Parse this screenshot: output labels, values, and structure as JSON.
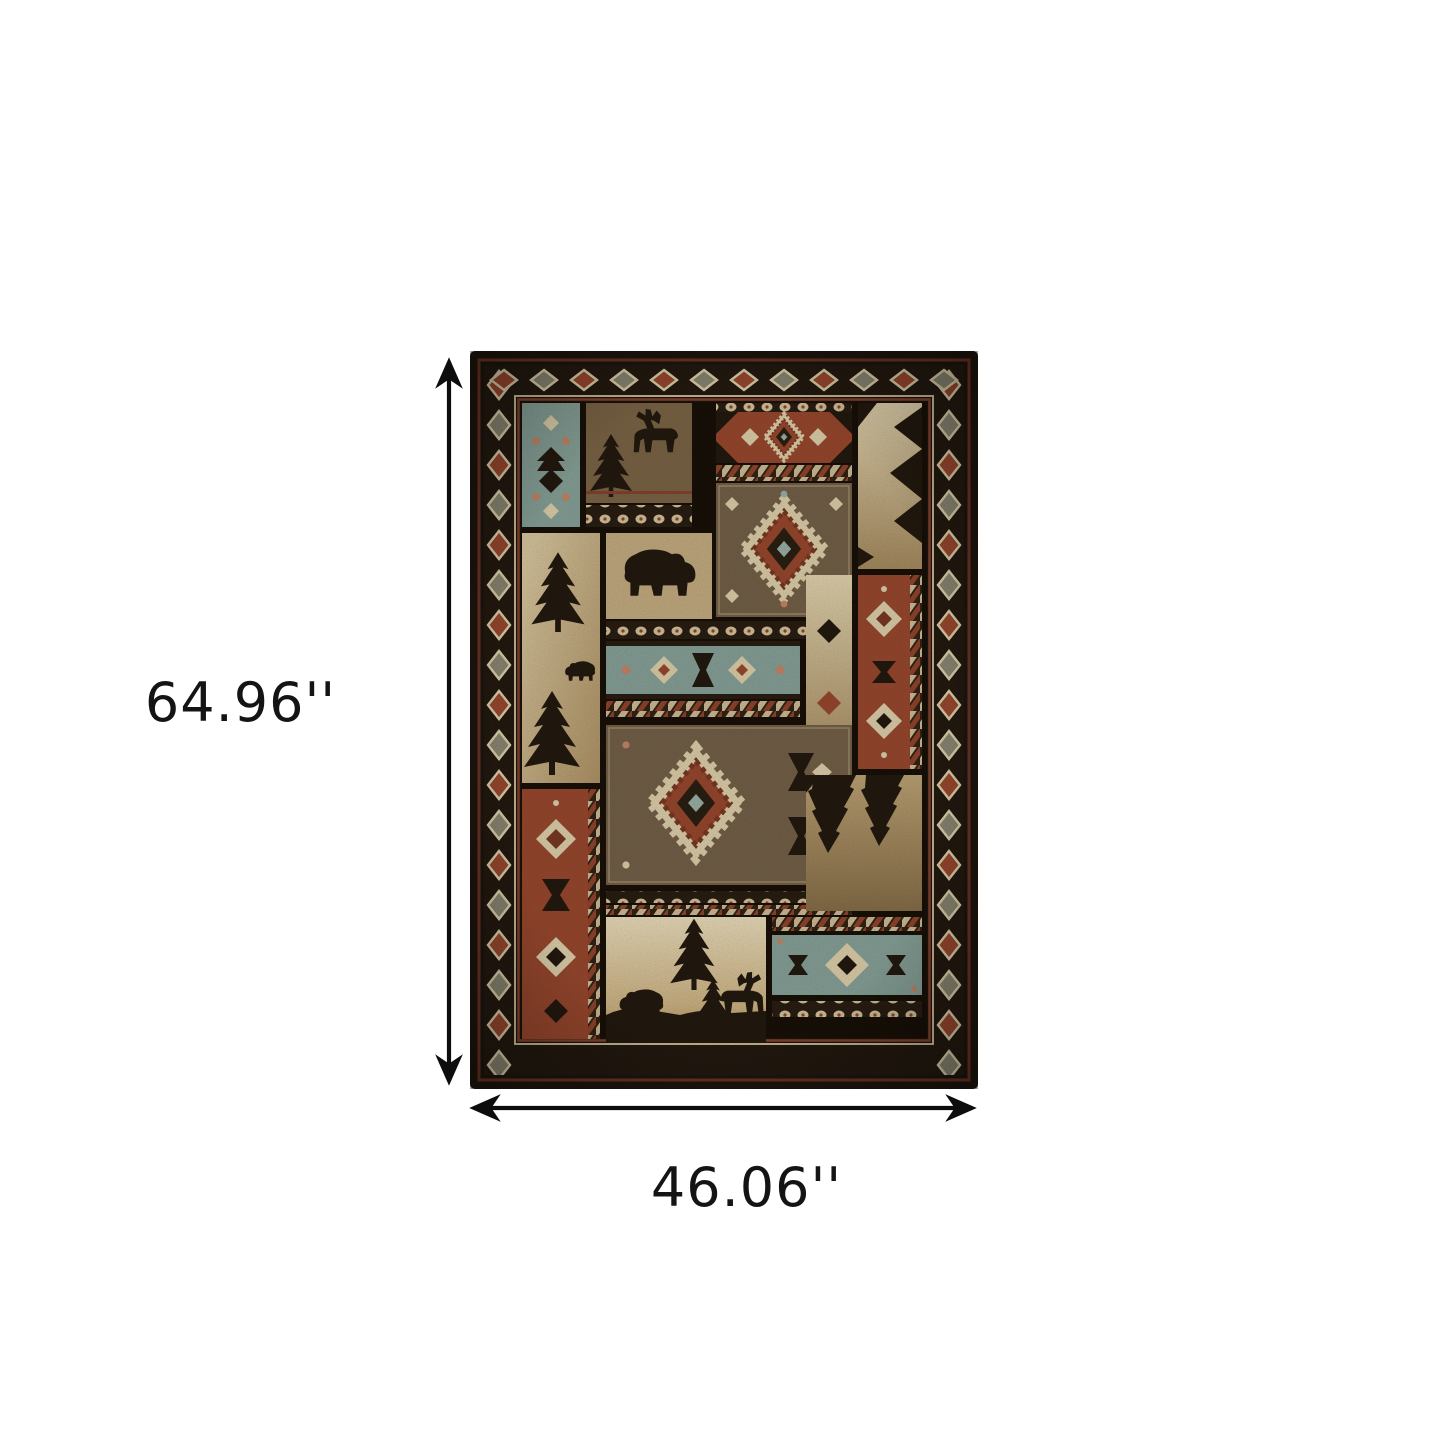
{
  "figure": {
    "type": "product-dimension-diagram",
    "background": "#ffffff"
  },
  "dimensions": {
    "height_label": "64.96''",
    "width_label": "46.06''"
  },
  "rug": {
    "description": "Black and brown rustic lodge patchwork area rug with moose, bear, pine tree and southwestern aztec motifs",
    "palette": {
      "background": "#ffffff",
      "arrow": "#0d0d0d",
      "label": "#141414",
      "border_dark": "#1f160e",
      "field_dark": "#191108",
      "rust": "#9d4a2f",
      "rust_deep": "#7d3a24",
      "cream": "#e4d5af",
      "beige": "#c9b184",
      "tan": "#ad9164",
      "olive": "#7e6747",
      "brown": "#77634a",
      "teal": "#8ba69c",
      "silhouette": "#241a0f"
    }
  }
}
